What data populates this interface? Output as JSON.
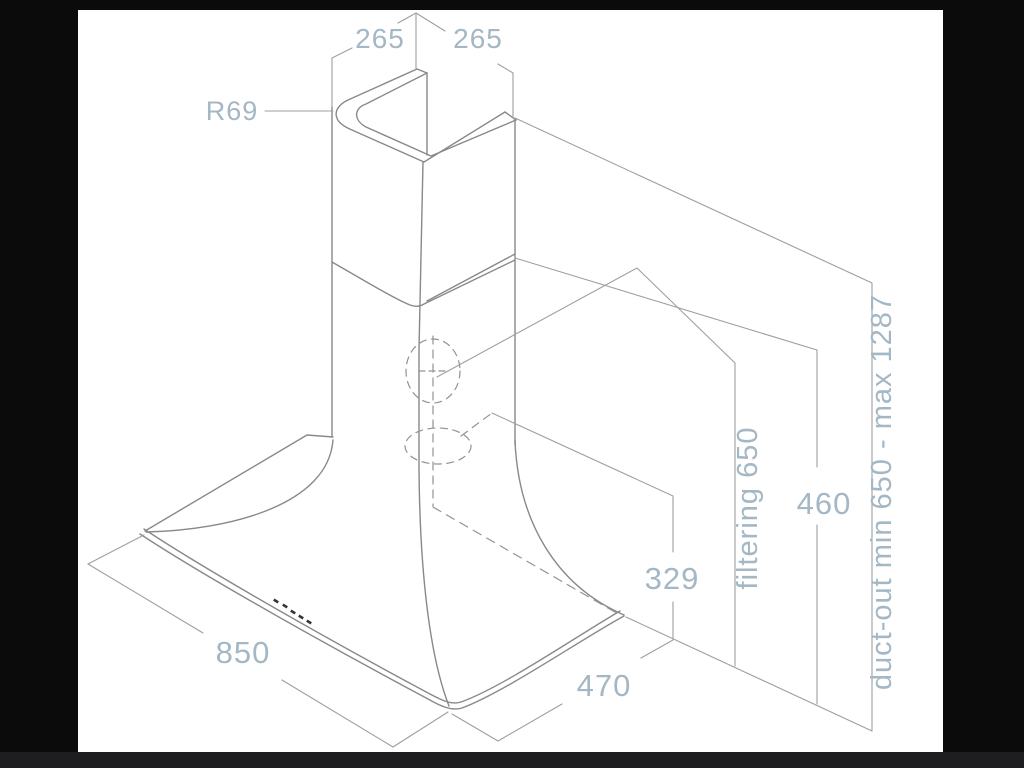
{
  "window": {
    "background": "#ffffff",
    "frame_color": "#0b0b0c",
    "frame_bottom_color": "#1e1e20"
  },
  "diagram": {
    "description": "Isometric dimensional drawing of a chimney cooker hood",
    "colors": {
      "object_line": "#87898a",
      "dimension_line": "#9ca0a2",
      "hidden_line": "#909394",
      "label_text": "#a4b7c4",
      "control_dots": "#333539"
    },
    "labels": {
      "width_top_left": "265",
      "width_top_right": "265",
      "corner_radius": "R69",
      "hood_width": "850",
      "hood_depth": "470",
      "rear_outlet_height": "329",
      "chimney_section_height": "460",
      "filtering_height": "filtering 650",
      "duct_out_range": "duct-out min 650 - max 1287"
    }
  }
}
